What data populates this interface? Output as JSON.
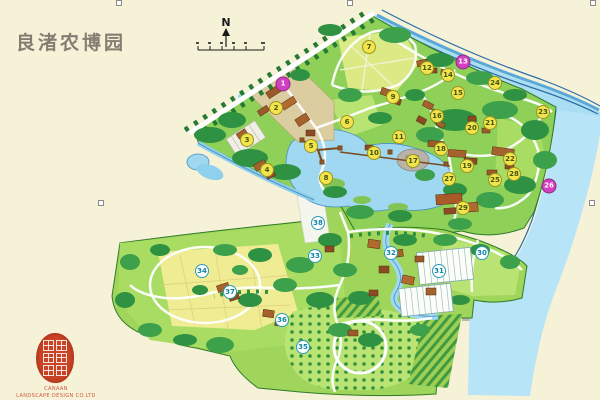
{
  "page": {
    "background": "#f5f2d8"
  },
  "title": {
    "text": "良渚农博园",
    "color": "#867d72"
  },
  "compass": {
    "label": "N"
  },
  "branding": {
    "company_line1": "CANAAN",
    "company_line2": "LANDSCAPE DESIGN CO.LTD",
    "color": "#d2553c"
  },
  "map": {
    "name": "Liangzhu Agricultural Expo Park master plan",
    "colors": {
      "land": "#8ed058",
      "field": "#b9e473",
      "crop_yellow": "#f0ec94",
      "forest": "#2e9242",
      "water": "#9fd8f0",
      "river": "#aadef2",
      "road": "#ffffff",
      "building": "#a5622c"
    },
    "marker_styles": {
      "yellow": {
        "bg": "#f3e44c",
        "text": "#40550f",
        "border": "#9a9422"
      },
      "pink": {
        "bg": "#d23fc0",
        "text": "#ffffff",
        "border": "#8e2a84"
      },
      "teal": {
        "bg": "#ffffff",
        "text": "#0e86a8",
        "border": "#2a9ab8"
      }
    },
    "markers": [
      {
        "label": "1",
        "x": 283,
        "y": 84,
        "type": "pink"
      },
      {
        "label": "2",
        "x": 276,
        "y": 108,
        "type": "yellow"
      },
      {
        "label": "3",
        "x": 247,
        "y": 140,
        "type": "yellow"
      },
      {
        "label": "4",
        "x": 267,
        "y": 170,
        "type": "yellow"
      },
      {
        "label": "5",
        "x": 311,
        "y": 146,
        "type": "yellow"
      },
      {
        "label": "6",
        "x": 347,
        "y": 122,
        "type": "yellow"
      },
      {
        "label": "7",
        "x": 369,
        "y": 47,
        "type": "yellow"
      },
      {
        "label": "8",
        "x": 326,
        "y": 178,
        "type": "yellow"
      },
      {
        "label": "9",
        "x": 393,
        "y": 97,
        "type": "yellow"
      },
      {
        "label": "10",
        "x": 374,
        "y": 153,
        "type": "yellow"
      },
      {
        "label": "11",
        "x": 399,
        "y": 137,
        "type": "yellow"
      },
      {
        "label": "12",
        "x": 427,
        "y": 68,
        "type": "yellow"
      },
      {
        "label": "13",
        "x": 463,
        "y": 62,
        "type": "pink"
      },
      {
        "label": "14",
        "x": 448,
        "y": 75,
        "type": "yellow"
      },
      {
        "label": "15",
        "x": 458,
        "y": 93,
        "type": "yellow"
      },
      {
        "label": "16",
        "x": 437,
        "y": 116,
        "type": "yellow"
      },
      {
        "label": "17",
        "x": 413,
        "y": 161,
        "type": "yellow"
      },
      {
        "label": "18",
        "x": 441,
        "y": 149,
        "type": "yellow"
      },
      {
        "label": "19",
        "x": 467,
        "y": 166,
        "type": "yellow"
      },
      {
        "label": "20",
        "x": 472,
        "y": 128,
        "type": "yellow"
      },
      {
        "label": "21",
        "x": 490,
        "y": 123,
        "type": "yellow"
      },
      {
        "label": "22",
        "x": 510,
        "y": 159,
        "type": "yellow"
      },
      {
        "label": "23",
        "x": 543,
        "y": 112,
        "type": "yellow"
      },
      {
        "label": "24",
        "x": 495,
        "y": 83,
        "type": "yellow"
      },
      {
        "label": "25",
        "x": 495,
        "y": 180,
        "type": "yellow"
      },
      {
        "label": "26",
        "x": 549,
        "y": 186,
        "type": "pink"
      },
      {
        "label": "27",
        "x": 449,
        "y": 179,
        "type": "yellow"
      },
      {
        "label": "28",
        "x": 514,
        "y": 174,
        "type": "yellow"
      },
      {
        "label": "29",
        "x": 463,
        "y": 208,
        "type": "yellow"
      },
      {
        "label": "30",
        "x": 482,
        "y": 253,
        "type": "teal"
      },
      {
        "label": "31",
        "x": 439,
        "y": 271,
        "type": "teal"
      },
      {
        "label": "32",
        "x": 391,
        "y": 253,
        "type": "teal"
      },
      {
        "label": "33",
        "x": 315,
        "y": 256,
        "type": "teal"
      },
      {
        "label": "34",
        "x": 202,
        "y": 271,
        "type": "teal"
      },
      {
        "label": "35",
        "x": 303,
        "y": 347,
        "type": "teal"
      },
      {
        "label": "36",
        "x": 282,
        "y": 320,
        "type": "teal"
      },
      {
        "label": "37",
        "x": 230,
        "y": 292,
        "type": "teal"
      },
      {
        "label": "38",
        "x": 318,
        "y": 223,
        "type": "teal"
      }
    ]
  }
}
